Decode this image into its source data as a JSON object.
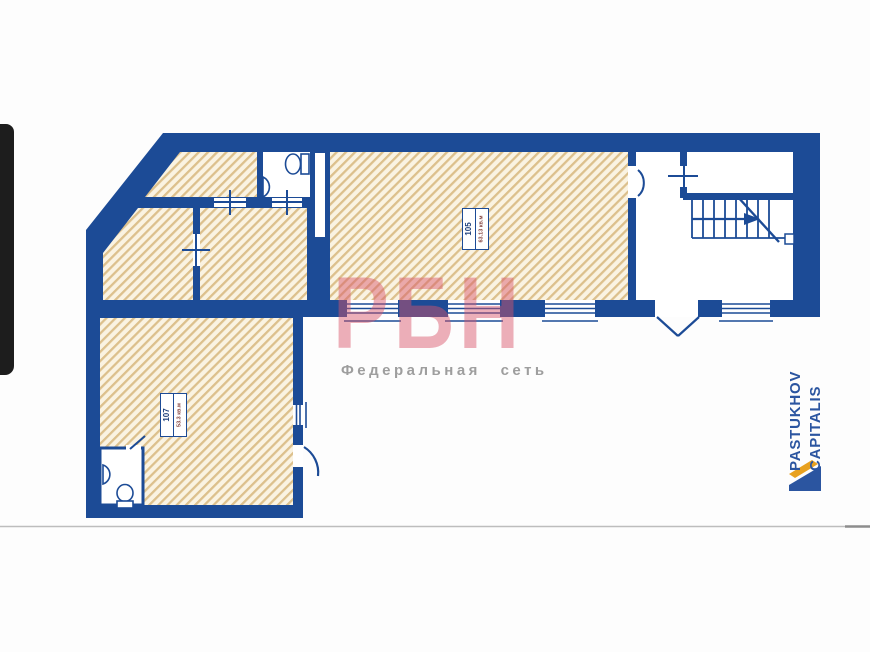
{
  "page": {
    "background": "#fdfdfd"
  },
  "watermark": {
    "brand": "РБН",
    "tagline": "Федеральная сеть",
    "brand_color": "#d9556b",
    "tagline_color": "#9e9e9e"
  },
  "agency": {
    "line1": "PASTUKHOV",
    "line2": "CAPITALIS",
    "text_color": "#2b55a0",
    "mark_blue": "#2b55a0",
    "mark_orange": "#e8a11f"
  },
  "floorplan": {
    "wall_color": "#1c4b96",
    "hatch_background": "#faf3e2",
    "hatch_line_color": "#dcc08c",
    "rooms": [
      {
        "number": "105",
        "area": "63.13 кв.м"
      },
      {
        "number": "107",
        "area": "53.3 кв.м"
      }
    ]
  }
}
